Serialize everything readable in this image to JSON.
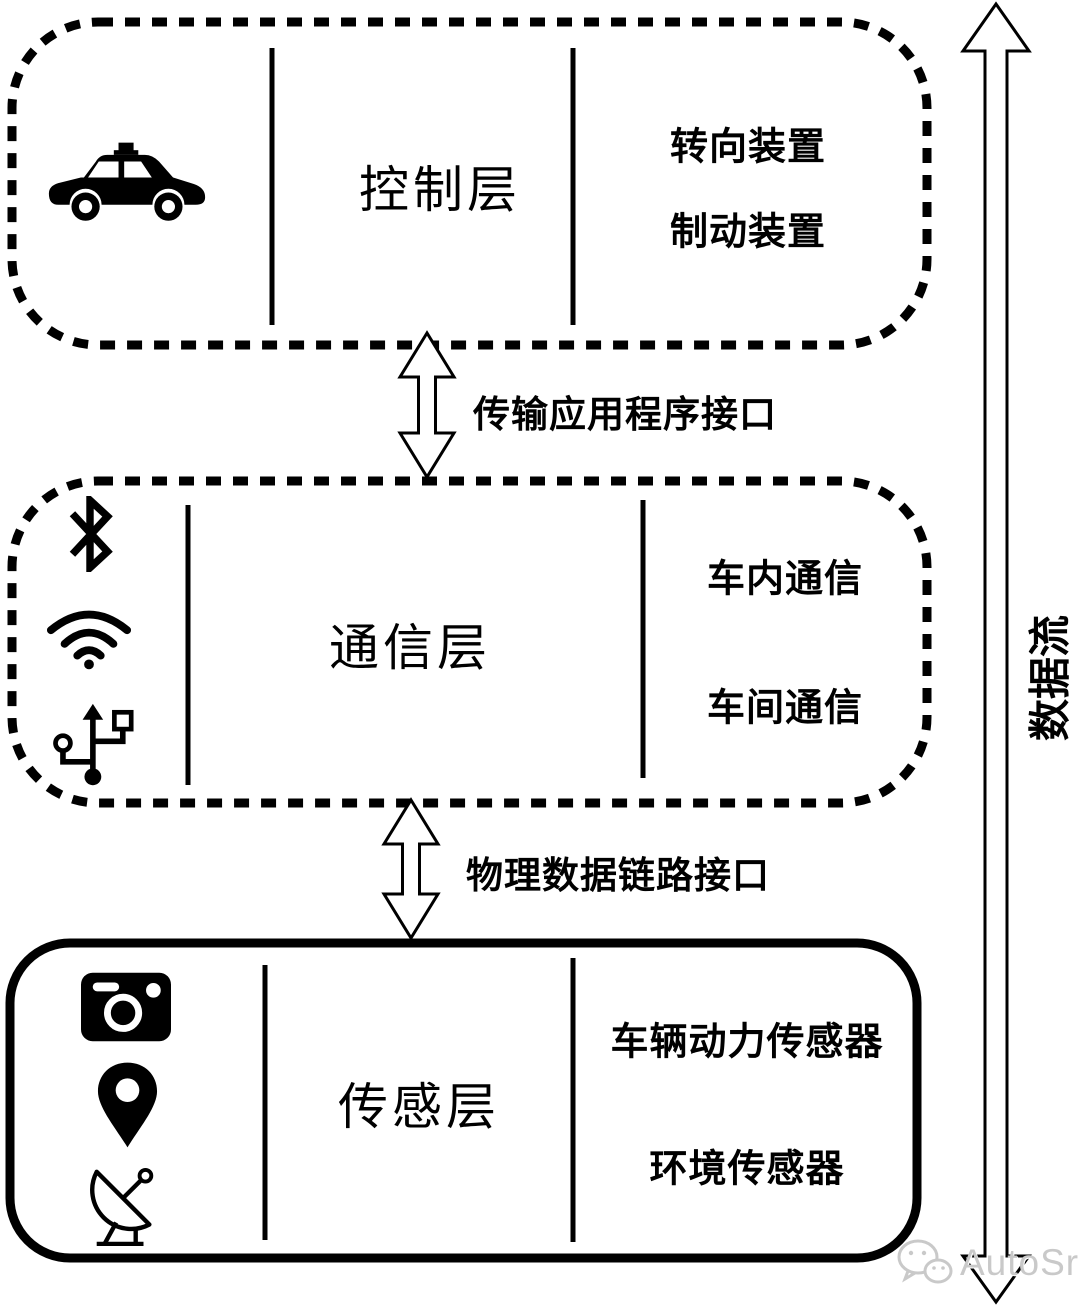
{
  "diagram": {
    "layers": [
      {
        "name": "control",
        "title": "控制层",
        "icons": [
          "car-icon"
        ],
        "devices": [
          "转向装置",
          "制动装置"
        ]
      },
      {
        "name": "communication",
        "title": "通信层",
        "icons": [
          "bluetooth-icon",
          "wifi-icon",
          "usb-icon"
        ],
        "devices": [
          "车内通信",
          "车间通信"
        ]
      },
      {
        "name": "sensing",
        "title": "传感层",
        "icons": [
          "camera-icon",
          "location-pin-icon",
          "satellite-dish-icon"
        ],
        "devices": [
          "车辆动力传感器",
          "环境传感器"
        ]
      }
    ],
    "interfaces": [
      {
        "label": "传输应用程序接口"
      },
      {
        "label": "物理数据链路接口"
      }
    ],
    "data_flow": {
      "label": "数据流"
    },
    "watermark": {
      "logo": "wechat-logo-icon",
      "text": "AutoSrc",
      "color": "#c9c9c9"
    },
    "colors": {
      "line": "#000000",
      "background": "#ffffff"
    }
  }
}
